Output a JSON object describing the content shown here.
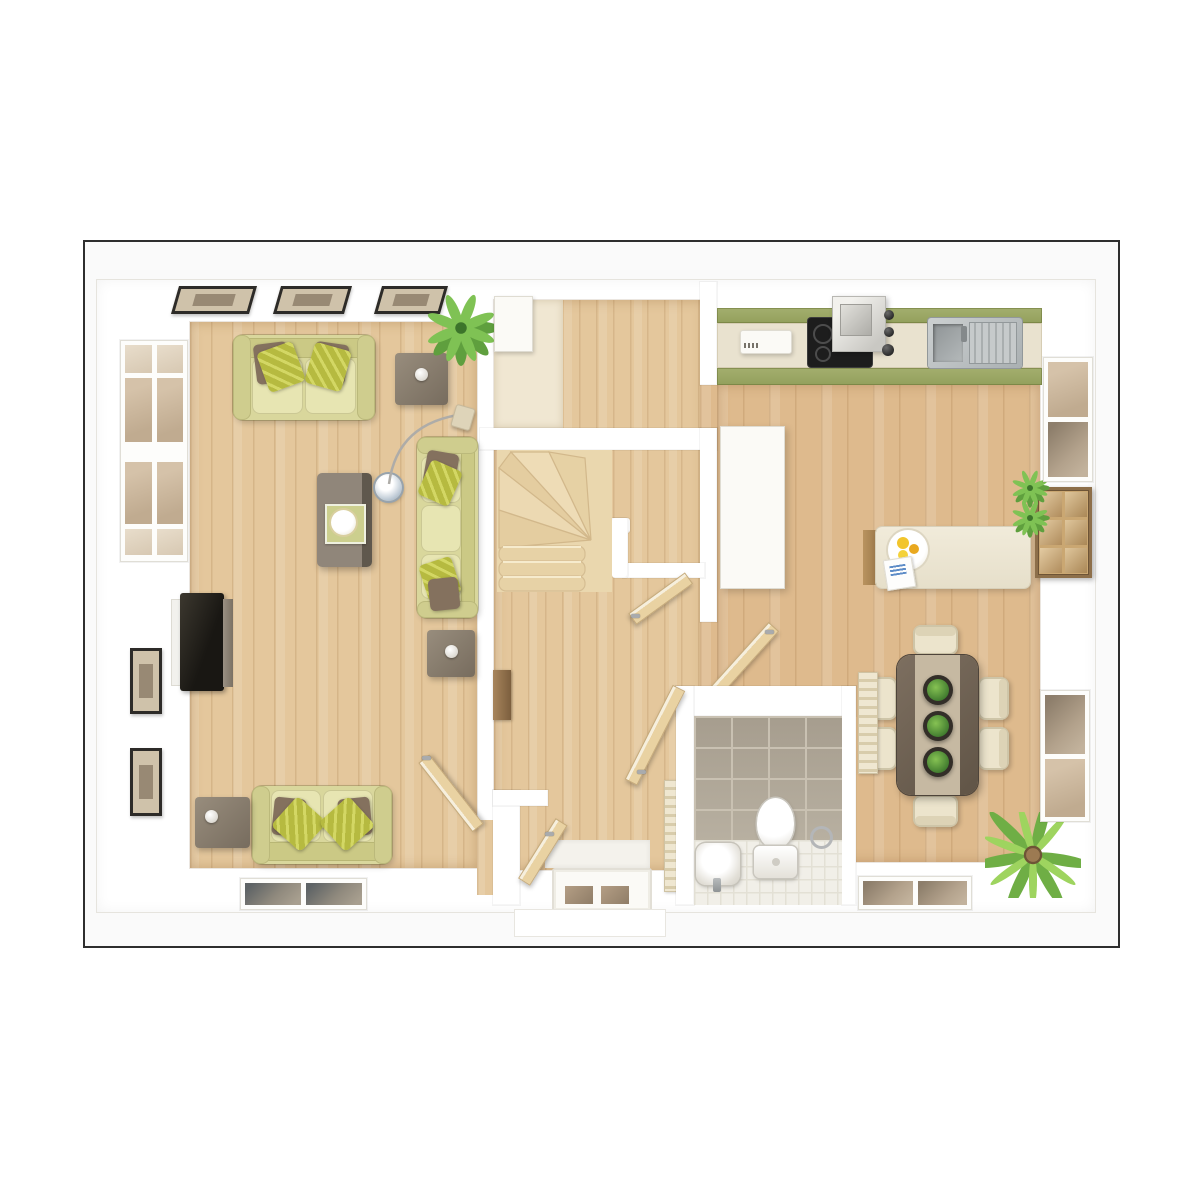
{
  "meta": {
    "title": "3D ground-floor plan — top-down render",
    "floor": "ground-floor",
    "render_style": "photoreal 3d dollhouse view, no text labels"
  },
  "colors": {
    "page_bg": "#ffffff",
    "plan_bg": "#fafafa",
    "frame": "#2e2e2e",
    "wall": "#ffffff",
    "wood_floor": "#e4c79c",
    "kitchen_floor": "#deba8d",
    "carpet": "#f0e7d2",
    "stairs_carpet": "#ead7ae",
    "sofa": "#d9d79c",
    "sofa_light": "#e7e5b2",
    "pillow_olive": "#b6ba40",
    "pillow_brown": "#84715e",
    "furniture_wood": "#8d8274",
    "cabinet_green": "#a3ae6e",
    "worktop": "#e9e2cf",
    "hob_black": "#1d1d1d",
    "table_dark": "#6e6050",
    "table_runner": "#c6b9a2",
    "chair_cream": "#ece4cc",
    "plant_green": "#5f9f3e",
    "plant_light": "#7fc254",
    "tile_beige": "#b2a99a",
    "wc_floor": "#f1efe8",
    "door_wood": "#e9d2a2",
    "glass_warm": "#d5c2a9",
    "picture_frame": "#2d2b28",
    "picture_mat": "#cfc2aa"
  },
  "rooms": [
    {
      "id": "living-room",
      "position": "left",
      "furniture": [
        "three-seat-sofa",
        "vertical-three-seat-sofa",
        "two-seat-sofa",
        "coffee-table",
        "round-accent-table",
        "side-table-1",
        "side-table-2",
        "side-table-3",
        "tv-panel",
        "arc-floor-lamp",
        "corner-plant"
      ],
      "wall_decor": [
        "picture-top-1",
        "picture-top-2",
        "picture-top-3",
        "picture-left-1",
        "picture-left-2"
      ],
      "windows": [
        "tall-left-window",
        "bottom-window"
      ]
    },
    {
      "id": "hallway",
      "position": "center",
      "furniture": [
        "winder-staircase",
        "handrail",
        "newel-post",
        "entry-cupboard",
        "wall-console",
        "radiator"
      ],
      "doors": [
        "front-door",
        "living-room-door",
        "kitchen-door",
        "stairs-lobby-door",
        "store-door",
        "wc-door"
      ]
    },
    {
      "id": "wc",
      "position": "bottom-center",
      "furniture": [
        "toilet",
        "pedestal-basin",
        "towel-ring"
      ],
      "finishes": [
        "beige-wall-tiles",
        "white-floor-tiles"
      ]
    },
    {
      "id": "kitchen-dining",
      "position": "right",
      "furniture": [
        "kitchen-counter-run",
        "extractor-hood",
        "ceramic-hob",
        "double-sink",
        "countertop-appliance",
        "tall-cupboard",
        "island-breakfast-bar",
        "fruit-plate",
        "magazine",
        "slatted-bar-chairs",
        "dining-table",
        "table-runner",
        "planter-x3",
        "dining-chair-x6",
        "palm-plant",
        "radiator",
        "plant-pot-x2"
      ],
      "windows": [
        "right-window-top",
        "right-window-bottom",
        "bottom-window"
      ]
    }
  ]
}
